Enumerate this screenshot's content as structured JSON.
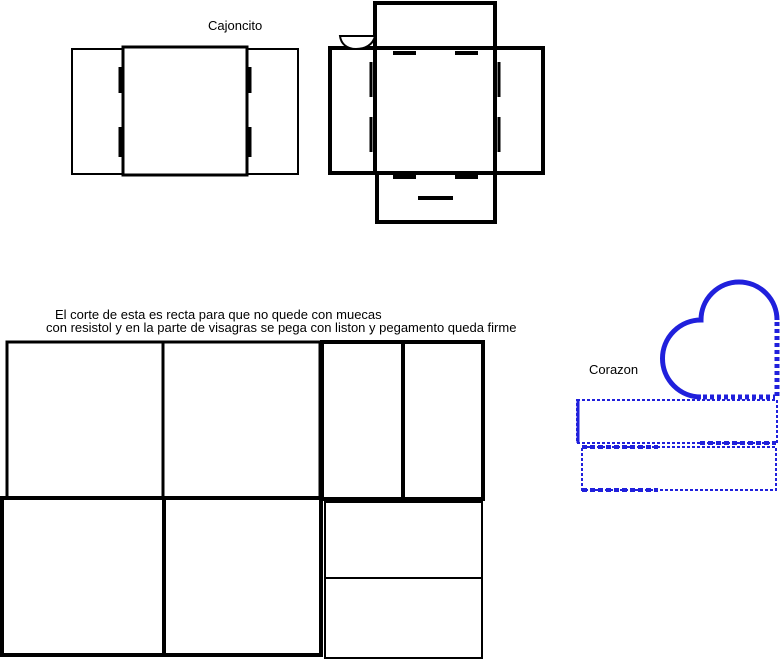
{
  "canvas": {
    "width": 781,
    "height": 662,
    "background": "#ffffff"
  },
  "colors": {
    "ink": "#000000",
    "blue": "#2020dc",
    "white": "#ffffff"
  },
  "labels": {
    "cajoncito": {
      "text": "Cajoncito",
      "x": 208,
      "y": 19
    },
    "note_line1": {
      "text": "El corte de esta es recta para que no quede con muecas",
      "x": 55,
      "y": 308
    },
    "note_line2": {
      "text": "con resistol y en la parte de visagras se pega con liston y pegamento queda firme",
      "x": 46,
      "y": 321
    },
    "corazon": {
      "text": "Corazon",
      "x": 589,
      "y": 363
    }
  },
  "shapes": [
    {
      "name": "cajoncito-outer-rect",
      "type": "rect",
      "x": 72,
      "y": 49,
      "w": 226,
      "h": 125,
      "stroke": "ink",
      "width": 2,
      "fill": "white"
    },
    {
      "name": "cajoncito-inner-square",
      "type": "rect",
      "x": 123,
      "y": 47,
      "w": 124,
      "h": 128,
      "stroke": "ink",
      "width": 3,
      "fill": "white"
    },
    {
      "name": "cajoncito-notch-left-1",
      "type": "line",
      "x1": 120,
      "y1": 67,
      "x2": 120,
      "y2": 93,
      "stroke": "ink",
      "width": 3
    },
    {
      "name": "cajoncito-notch-left-2",
      "type": "line",
      "x1": 120,
      "y1": 127,
      "x2": 120,
      "y2": 157,
      "stroke": "ink",
      "width": 3
    },
    {
      "name": "cajoncito-notch-right-1",
      "type": "line",
      "x1": 250,
      "y1": 67,
      "x2": 250,
      "y2": 93,
      "stroke": "ink",
      "width": 3
    },
    {
      "name": "cajoncito-notch-right-2",
      "type": "line",
      "x1": 250,
      "y1": 127,
      "x2": 250,
      "y2": 157,
      "stroke": "ink",
      "width": 3
    },
    {
      "name": "boxnet-top-flap",
      "type": "rect",
      "x": 375,
      "y": 3,
      "w": 120,
      "h": 45,
      "stroke": "ink",
      "width": 4,
      "fill": "white"
    },
    {
      "name": "boxnet-side-band",
      "type": "rect",
      "x": 330,
      "y": 48,
      "w": 213,
      "h": 125,
      "stroke": "ink",
      "width": 4,
      "fill": "white"
    },
    {
      "name": "boxnet-bottom-flap",
      "type": "rect",
      "x": 377,
      "y": 173,
      "w": 118,
      "h": 49,
      "stroke": "ink",
      "width": 4,
      "fill": "white"
    },
    {
      "name": "boxnet-center-square",
      "type": "rect",
      "x": 375,
      "y": 48,
      "w": 120,
      "h": 125,
      "stroke": "ink",
      "width": 4,
      "fill": "white"
    },
    {
      "name": "boxnet-notch-top-1",
      "type": "line",
      "x1": 393,
      "y1": 53,
      "x2": 416,
      "y2": 53,
      "stroke": "ink",
      "width": 4
    },
    {
      "name": "boxnet-notch-top-2",
      "type": "line",
      "x1": 455,
      "y1": 53,
      "x2": 478,
      "y2": 53,
      "stroke": "ink",
      "width": 4
    },
    {
      "name": "boxnet-notch-bottom-1",
      "type": "line",
      "x1": 393,
      "y1": 177,
      "x2": 416,
      "y2": 177,
      "stroke": "ink",
      "width": 4
    },
    {
      "name": "boxnet-notch-bottom-2",
      "type": "line",
      "x1": 455,
      "y1": 177,
      "x2": 478,
      "y2": 177,
      "stroke": "ink",
      "width": 4
    },
    {
      "name": "boxnet-notch-left-1",
      "type": "line",
      "x1": 371,
      "y1": 62,
      "x2": 371,
      "y2": 97,
      "stroke": "ink",
      "width": 3
    },
    {
      "name": "boxnet-notch-left-2",
      "type": "line",
      "x1": 371,
      "y1": 117,
      "x2": 371,
      "y2": 152,
      "stroke": "ink",
      "width": 3
    },
    {
      "name": "boxnet-notch-right-1",
      "type": "line",
      "x1": 499,
      "y1": 62,
      "x2": 499,
      "y2": 97,
      "stroke": "ink",
      "width": 3
    },
    {
      "name": "boxnet-notch-right-2",
      "type": "line",
      "x1": 499,
      "y1": 117,
      "x2": 499,
      "y2": 152,
      "stroke": "ink",
      "width": 3
    },
    {
      "name": "boxnet-glue-dash",
      "type": "line",
      "x1": 418,
      "y1": 198,
      "x2": 453,
      "y2": 198,
      "stroke": "ink",
      "width": 4
    },
    {
      "name": "boxnet-bowl",
      "type": "path",
      "d": "M340,36 H375 C373,45 365,49 356,49 C347,49 341,44 340,36 Z",
      "stroke": "ink",
      "width": 2,
      "fill": "white"
    },
    {
      "name": "template-left-top-rect",
      "type": "rect",
      "x": 7,
      "y": 342,
      "w": 313,
      "h": 156,
      "stroke": "ink",
      "width": 3,
      "fill": "white"
    },
    {
      "name": "template-left-top-divider",
      "type": "line",
      "x1": 163,
      "y1": 342,
      "x2": 163,
      "y2": 498,
      "stroke": "ink",
      "width": 3
    },
    {
      "name": "template-left-bottom-rect",
      "type": "rect",
      "x": 2,
      "y": 498,
      "w": 319,
      "h": 157,
      "stroke": "ink",
      "width": 4,
      "fill": "white"
    },
    {
      "name": "template-left-bottom-divider",
      "type": "line",
      "x1": 164,
      "y1": 498,
      "x2": 164,
      "y2": 655,
      "stroke": "ink",
      "width": 4
    },
    {
      "name": "template-right-top-rect",
      "type": "rect",
      "x": 322,
      "y": 342,
      "w": 161,
      "h": 157,
      "stroke": "ink",
      "width": 4,
      "fill": "white"
    },
    {
      "name": "template-right-top-divider",
      "type": "line",
      "x1": 403,
      "y1": 342,
      "x2": 403,
      "y2": 499,
      "stroke": "ink",
      "width": 4
    },
    {
      "name": "template-right-bottom-rect",
      "type": "rect",
      "x": 325,
      "y": 502,
      "w": 157,
      "h": 156,
      "stroke": "ink",
      "width": 2,
      "fill": "white"
    },
    {
      "name": "template-right-bottom-divider",
      "type": "line",
      "x1": 325,
      "y1": 578,
      "x2": 482,
      "y2": 578,
      "stroke": "ink",
      "width": 2
    },
    {
      "name": "heart-body",
      "type": "path",
      "d": "M777,320 L777,397 L701,397 A38.5,38.5 0 0 1 701,320 A38,38 0 0 1 777,320 Z",
      "fill": "white"
    },
    {
      "name": "heart-outline-arcs",
      "type": "path",
      "d": "M701,397 A38.5,38.5 0 0 1 701,320 A38,38 0 0 1 777,320",
      "stroke": "blue",
      "width": 5
    },
    {
      "name": "heart-fold-edge-right",
      "type": "line",
      "x1": 777,
      "y1": 322,
      "x2": 777,
      "y2": 397,
      "stroke": "blue",
      "width": 5,
      "dash": "4 3"
    },
    {
      "name": "heart-fold-edge-bottom",
      "type": "line",
      "x1": 703,
      "y1": 397,
      "x2": 775,
      "y2": 397,
      "stroke": "blue",
      "width": 5,
      "dash": "4 3"
    },
    {
      "name": "heart-strip-1",
      "type": "rect",
      "x": 577,
      "y": 400,
      "w": 200,
      "h": 43,
      "stroke": "blue",
      "width": 2,
      "dash": "3 2",
      "fill": "white"
    },
    {
      "name": "heart-strip-1-left-edge",
      "type": "line",
      "x1": 578,
      "y1": 400,
      "x2": 578,
      "y2": 443,
      "stroke": "blue",
      "width": 3
    },
    {
      "name": "heart-strip-1-fold-bottom",
      "type": "line",
      "x1": 700,
      "y1": 443,
      "x2": 776,
      "y2": 443,
      "stroke": "blue",
      "width": 4,
      "dash": "5 3"
    },
    {
      "name": "heart-strip-2",
      "type": "rect",
      "x": 582,
      "y": 447,
      "w": 194,
      "h": 43,
      "stroke": "blue",
      "width": 2,
      "dash": "3 2",
      "fill": "white"
    },
    {
      "name": "heart-strip-2-fold-top",
      "type": "line",
      "x1": 582,
      "y1": 447,
      "x2": 658,
      "y2": 447,
      "stroke": "blue",
      "width": 4,
      "dash": "5 3"
    },
    {
      "name": "heart-strip-2-fold-bottom",
      "type": "line",
      "x1": 582,
      "y1": 490,
      "x2": 658,
      "y2": 490,
      "stroke": "blue",
      "width": 4,
      "dash": "5 3"
    }
  ]
}
